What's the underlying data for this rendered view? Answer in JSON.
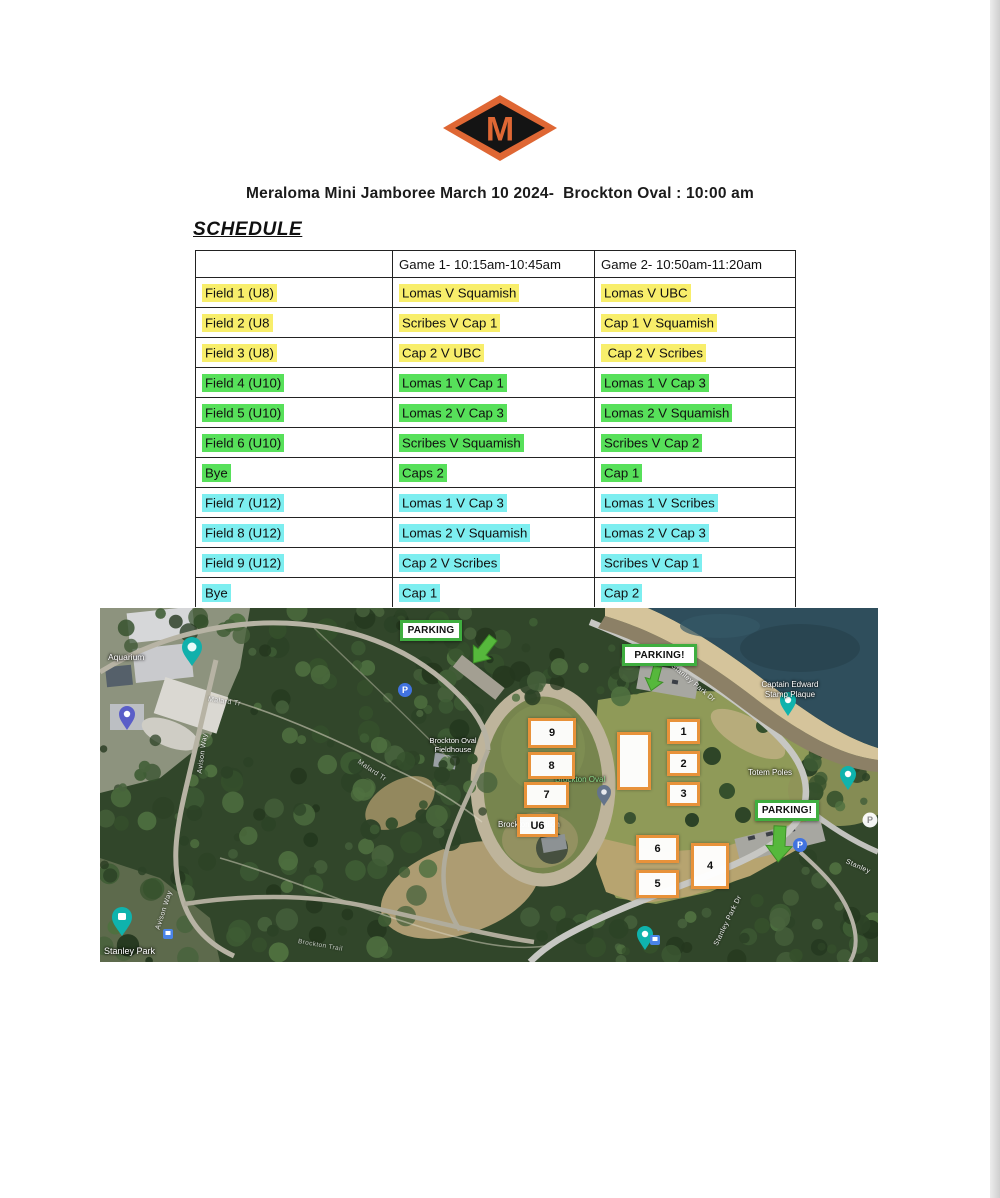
{
  "page": {
    "title": "Meraloma Mini Jamboree March 10 2024-  Brockton Oval : 10:00 am",
    "schedule_heading": "SCHEDULE",
    "logo_letter": "M"
  },
  "colors": {
    "logo_orange": "#df6734",
    "logo_black": "#141414",
    "hl_yellow": "#f8ee6b",
    "hl_green": "#57e05a",
    "hl_cyan": "#7deef0",
    "parking_green": "#3fae3f",
    "field_box_orange": "#e8923a"
  },
  "table": {
    "headers": [
      "",
      "Game 1- 10:15am-10:45am",
      "Game 2- 10:50am-11:20am"
    ],
    "rows": [
      {
        "field": "Field 1 (U8)",
        "game1": "Lomas V Squamish",
        "game2": "Lomas V UBC",
        "hl": "yellow"
      },
      {
        "field": "Field 2 (U8",
        "game1": "Scribes V Cap 1",
        "game2": "Cap 1 V Squamish",
        "hl": "yellow"
      },
      {
        "field": "Field 3 (U8)",
        "game1": "Cap 2 V UBC",
        "game2": " Cap 2 V Scribes",
        "hl": "yellow"
      },
      {
        "field": "Field 4 (U10)",
        "game1": "Lomas 1 V Cap 1",
        "game2": "Lomas 1 V Cap 3",
        "hl": "green"
      },
      {
        "field": "Field 5 (U10)",
        "game1": "Lomas 2 V Cap 3",
        "game2": "Lomas 2 V Squamish",
        "hl": "green"
      },
      {
        "field": "Field 6 (U10)",
        "game1": "Scribes V Squamish",
        "game2": "Scribes V Cap 2",
        "hl": "green"
      },
      {
        "field": "Bye",
        "game1": "Caps 2",
        "game2": "Cap 1",
        "hl": "green"
      },
      {
        "field": "Field 7 (U12)",
        "game1": "Lomas 1 V Cap 3",
        "game2": "Lomas 1 V Scribes",
        "hl": "cyan"
      },
      {
        "field": "Field 8 (U12)",
        "game1": "Lomas 2 V Squamish",
        "game2": "Lomas 2 V Cap 3",
        "hl": "cyan"
      },
      {
        "field": "Field 9 (U12)",
        "game1": "Cap 2 V Scribes",
        "game2": "Scribes V Cap 1",
        "hl": "cyan"
      },
      {
        "field": "Bye",
        "game1": "Cap 1",
        "game2": "Cap 2",
        "hl": "cyan"
      }
    ]
  },
  "map": {
    "parking_labels": [
      "PARKING",
      "PARKING!",
      "PARKING!"
    ],
    "field_markers": [
      "9",
      "8",
      "7",
      "U6",
      "",
      "1",
      "2",
      "3",
      "6",
      "5",
      "4"
    ],
    "places": {
      "aquarium": "Aquarium",
      "fieldhouse_line1": "Brockton Oval",
      "fieldhouse_line2": "Fieldhouse",
      "brockton_oval": "Brockton Oval",
      "pavilion": "Brockton Pavilion",
      "plaque_line1": "Captain Edward",
      "plaque_line2": "Stamp Plaque",
      "totem": "Totem Poles",
      "stanley_park": "Stanley Park"
    },
    "roads": {
      "avison_1": "Avison Way",
      "avison_2": "Avison Way",
      "malard_1": "Malard Tr",
      "malard_2": "Malard Tr",
      "spd_top": "Stanley Park Dr",
      "spd_bottom": "Stanley Park Dr",
      "stanley_right": "Stanley",
      "brockton_trail": "Brockton Trail"
    }
  }
}
